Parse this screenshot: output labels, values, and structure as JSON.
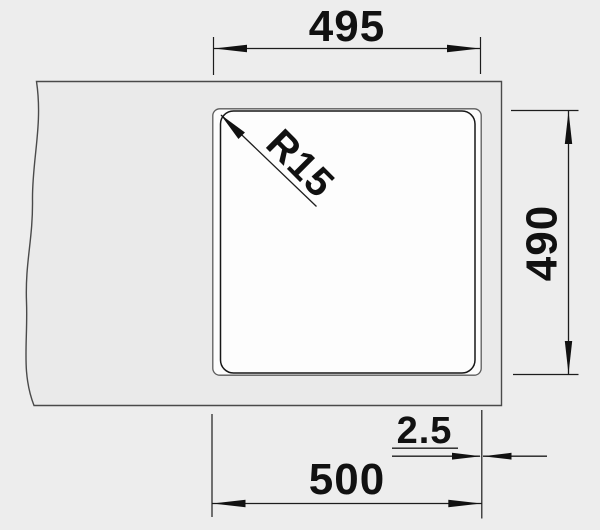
{
  "title": "Sink cutout installation drawing",
  "colors": {
    "background": "#ededed",
    "countertop_fill": "#eaeaea",
    "cutout_fill": "#fdfdfd",
    "line": "#1d1d1d",
    "text": "#111111"
  },
  "dims": {
    "cutout_width": "495",
    "corner_radius": "R15",
    "depth": "490",
    "rim_offset": "2.5",
    "overall_width": "500"
  }
}
